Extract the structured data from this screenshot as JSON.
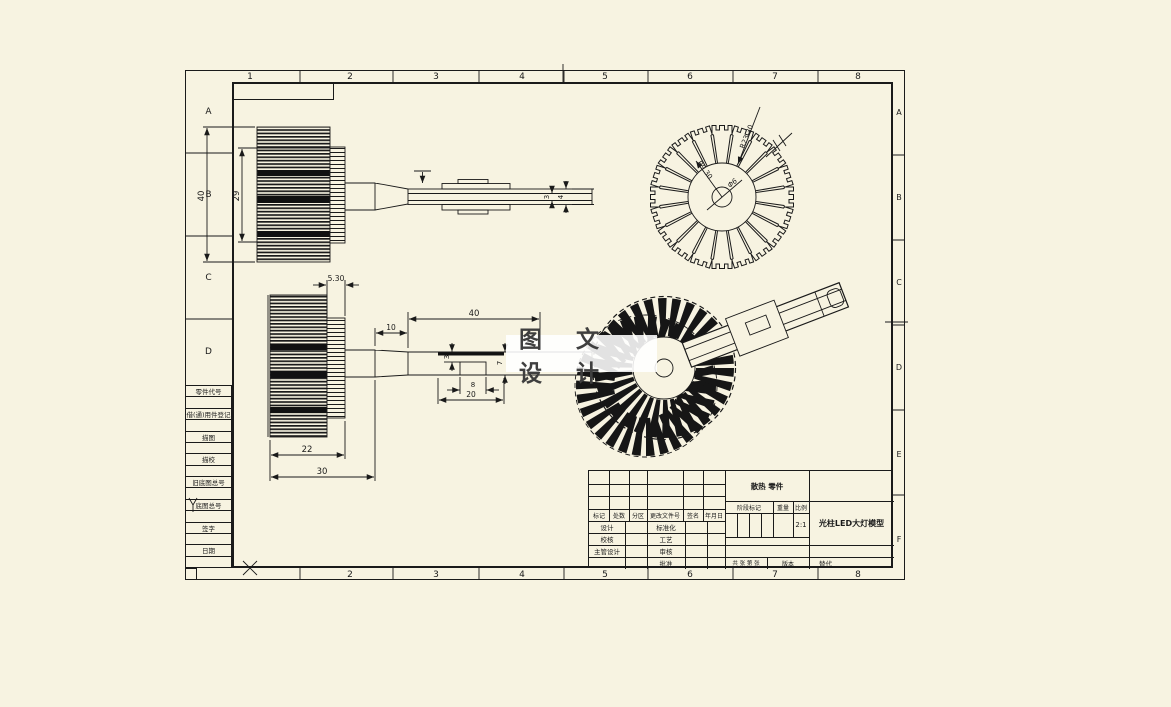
{
  "colors": {
    "paper": "#f7f3e1",
    "line": "#1a1a1a",
    "watermark_bg": "#ffffff",
    "watermark_text": "#3f3f3f"
  },
  "watermark": {
    "text": "图 文 设 计"
  },
  "zones": {
    "top": [
      "1",
      "2",
      "3",
      "4",
      "5",
      "6",
      "7",
      "8"
    ],
    "bottom": [
      "2",
      "3",
      "4",
      "5",
      "6",
      "7",
      "8"
    ],
    "left": [
      "A",
      "B",
      "C",
      "D"
    ],
    "right": [
      "A",
      "B",
      "C",
      "D",
      "E",
      "F"
    ]
  },
  "margin_table": {
    "rows": [
      "零件代号",
      "借(通)用件登记",
      "描图",
      "描校",
      "旧底图总号",
      "底图总号",
      "签字",
      "日期"
    ]
  },
  "title_block": {
    "material_mark": "散热 零件",
    "revision_header": [
      "标记",
      "处数",
      "分区",
      "更改文件号",
      "签名",
      "年月日"
    ],
    "sign_rows_left": [
      "设计",
      "校核",
      "主管设计"
    ],
    "sign_rows_mid": [
      "标准化",
      "工艺",
      "审核",
      "批准"
    ],
    "stage_label": "阶段标记",
    "weight_label": "重量",
    "scale_label": "比例",
    "scale_value": "2:1",
    "title": "光柱LED大灯模型",
    "sheets_label": "共 张 第 张",
    "version_label": "版本",
    "substitute_label": "替代"
  },
  "dims": {
    "v1": {
      "h": "40",
      "inner": "29",
      "t3": "3",
      "t4": "4"
    },
    "v2": {
      "step": "5.30",
      "neck": "10",
      "len": "40",
      "d3": "3",
      "d8": "8",
      "d20": "20",
      "d7": "7",
      "d22": "22",
      "d30": "30"
    },
    "v3": {
      "outer_r": "R23.30",
      "inner_r": "R9.30",
      "hole": "Φ6"
    }
  }
}
